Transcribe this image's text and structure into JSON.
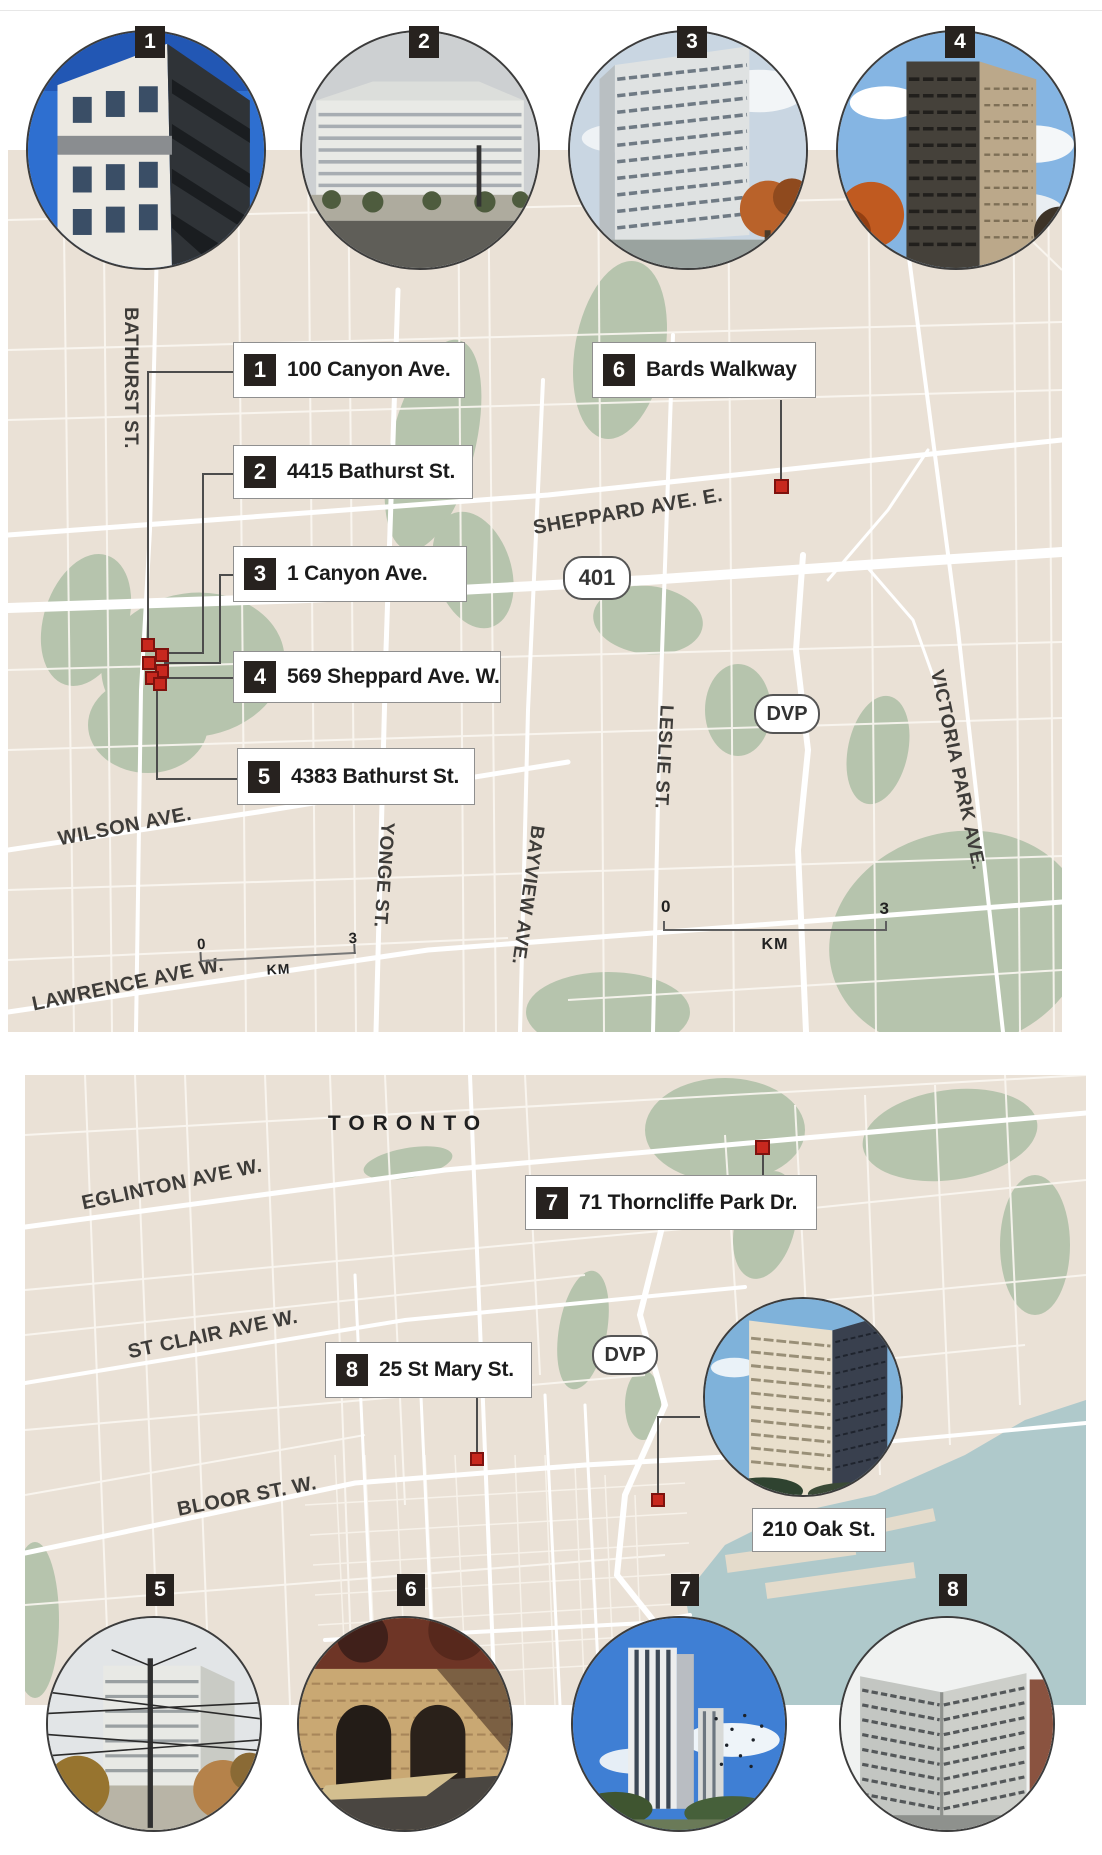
{
  "photos_top": [
    {
      "num": "1"
    },
    {
      "num": "2"
    },
    {
      "num": "3"
    },
    {
      "num": "4"
    }
  ],
  "photos_bottom": [
    {
      "num": "5"
    },
    {
      "num": "6"
    },
    {
      "num": "7"
    },
    {
      "num": "8"
    }
  ],
  "map1": {
    "callouts": [
      {
        "num": "1",
        "label": "100 Canyon Ave."
      },
      {
        "num": "2",
        "label": "4415 Bathurst St."
      },
      {
        "num": "3",
        "label": "1 Canyon Ave."
      },
      {
        "num": "4",
        "label": "569 Sheppard Ave. W."
      },
      {
        "num": "5",
        "label": "4383 Bathurst St."
      },
      {
        "num": "6",
        "label": "Bards Walkway"
      }
    ],
    "streets": {
      "bathurst": "BATHURST ST.",
      "sheppard": "SHEPPARD AVE. E.",
      "wilson": "WILSON AVE.",
      "lawrence": "LAWRENCE AVE W.",
      "yonge": "YONGE ST.",
      "bayview": "BAYVIEW AVE.",
      "leslie": "LESLIE ST.",
      "victoria": "VICTORIA PARK AVE."
    },
    "shields": {
      "hwy401": "401",
      "dvp": "DVP"
    },
    "scale": {
      "start": "0",
      "end": "3",
      "unit": "KM"
    },
    "scale_small": {
      "start": "0",
      "end": "3",
      "unit": "KM"
    }
  },
  "map2": {
    "city": "TORONTO",
    "callouts": [
      {
        "num": "7",
        "label": "71 Thorncliffe Park Dr."
      },
      {
        "num": "8",
        "label": "25 St Mary St."
      }
    ],
    "photo_callout": {
      "label": "210 Oak St."
    },
    "streets": {
      "eglinton": "EGLINTON AVE W.",
      "stclair": "ST CLAIR AVE W.",
      "bloor": "BLOOR ST. W."
    },
    "shields": {
      "dvp": "DVP"
    }
  }
}
